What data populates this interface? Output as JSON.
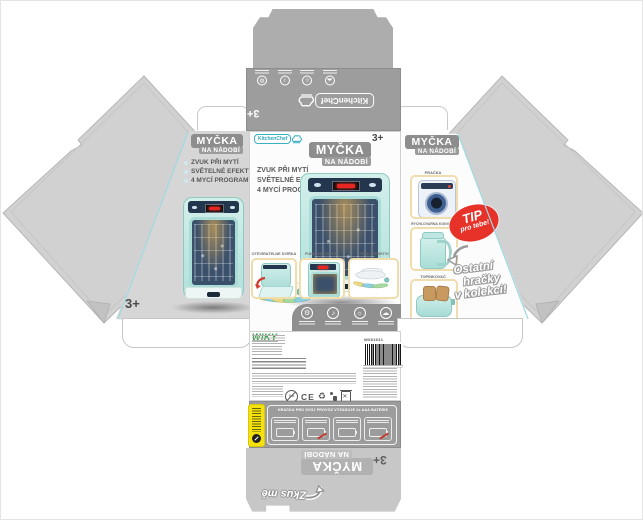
{
  "product": {
    "title_line1": "MYČKA",
    "title_line2": "NA NÁDOBÍ",
    "age": "3+"
  },
  "brand": {
    "logo": "KitchenChef",
    "distributor": "WIKY"
  },
  "features": {
    "bullet_items": [
      "ZVUK PŘI MYTÍ",
      "SVĚTELNÉ EFEKTY",
      "4 MYCÍ PROGRAMY"
    ]
  },
  "front": {
    "cards": [
      {
        "label": "OTEVÍRATELNÉ DVÍŘKA"
      },
      {
        "label": "FUNKČNÍ DISPLEJ"
      },
      {
        "label": "PŘÍSLUŠENSTVÍ"
      }
    ]
  },
  "collection": {
    "tip_line1": "TIP",
    "tip_line2": "pro tebe!",
    "note_lines": [
      "Ostatní",
      "hračky",
      "v kolekci!"
    ],
    "items": [
      {
        "label": "PRAČKA"
      },
      {
        "label": "RYCHLOVARNÁ KONVICE"
      },
      {
        "label": "TOPINKOVAČ"
      }
    ]
  },
  "back": {
    "product_code": "W081631",
    "battery_note": "HRAČKA PRO SVŮJ PROVOZ VYŽADUJE 2x AAA BATERIE",
    "ce_mark": "CE",
    "age_warning": "0-3"
  },
  "flap": {
    "try_me": "Zkus mě"
  },
  "glyphs": {
    "gear": "⚙",
    "sound": "♪",
    "light": "☼",
    "steam": "☁",
    "recycle": "♻"
  },
  "colors": {
    "accent_teal": "#3fb6c9",
    "tip_red": "#e63229",
    "brand_green": "#2f9e41",
    "tag_yellow": "#f4e10d",
    "mint": "#bfe5e1",
    "panel_gray": "#9c9c9c"
  }
}
